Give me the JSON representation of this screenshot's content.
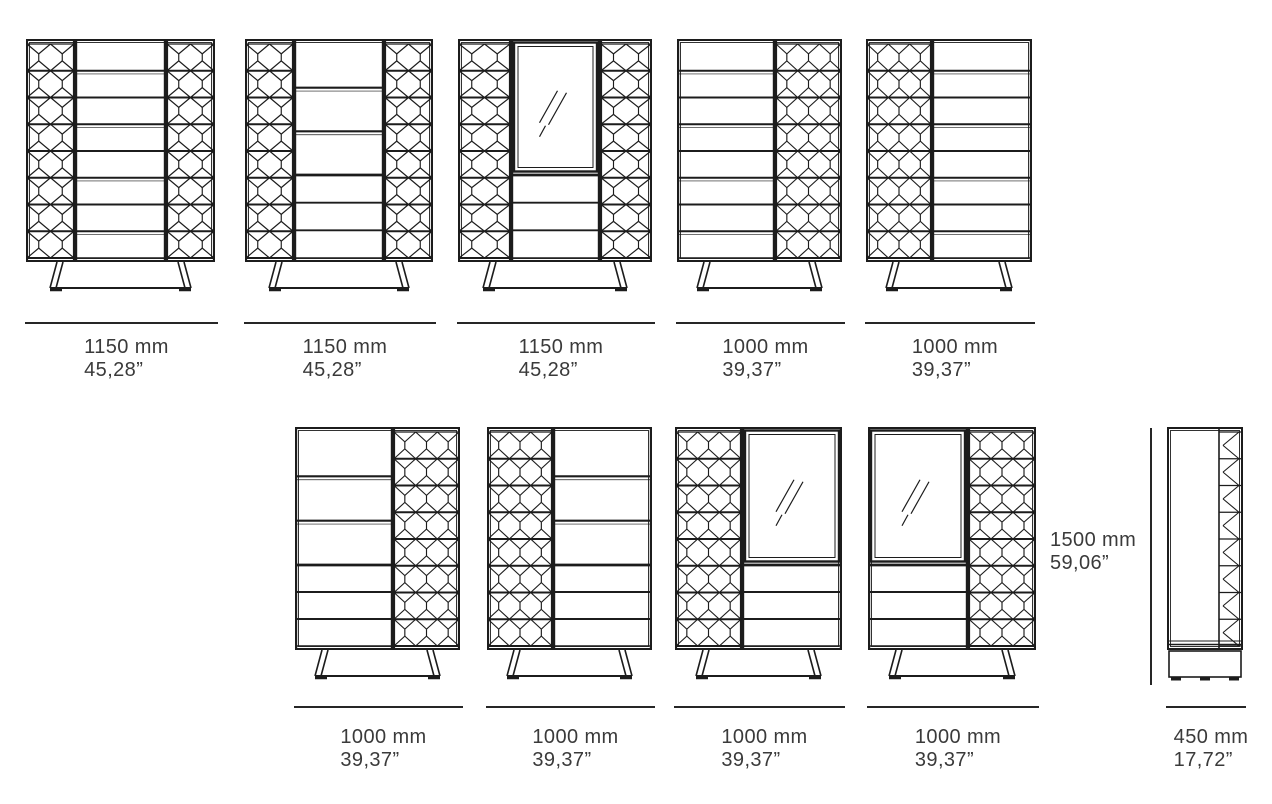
{
  "diagram": {
    "title": "Highboard dimension drawings",
    "colors": {
      "line": "#1c1c1c",
      "text": "#3a3a3a",
      "background": "#ffffff"
    },
    "height_annotation": {
      "mm": "1500 mm",
      "inches": "59,06”"
    },
    "height_line": {
      "x": 1150,
      "y1": 428,
      "y2": 685
    },
    "figures": [
      {
        "name": "highboard-1150-pattern-doors-8-drawers",
        "view": "front",
        "x": 26,
        "y": 39,
        "w": 189,
        "dim_y": 322,
        "label_y": 336,
        "label": {
          "mm": "1150 mm",
          "inches": "45,28”"
        },
        "sections": [
          {
            "type": "pattern",
            "w": 49,
            "cells": 2
          },
          {
            "type": "drawers8",
            "w": 91
          },
          {
            "type": "pattern",
            "w": 49,
            "cells": 2
          }
        ]
      },
      {
        "name": "highboard-1150-three-big-drawers",
        "view": "front",
        "x": 245,
        "y": 39,
        "w": 188,
        "dim_y": 322,
        "label_y": 336,
        "label": {
          "mm": "1150 mm",
          "inches": "45,28”"
        },
        "sections": [
          {
            "type": "pattern",
            "w": 49,
            "cells": 2
          },
          {
            "type": "drawersBig",
            "w": 90,
            "split": 136
          },
          {
            "type": "pattern",
            "w": 49,
            "cells": 2
          }
        ]
      },
      {
        "name": "highboard-1150-glass-door",
        "view": "front",
        "x": 458,
        "y": 39,
        "w": 194,
        "dim_y": 322,
        "label_y": 336,
        "label": {
          "mm": "1150 mm",
          "inches": "45,28”"
        },
        "sections": [
          {
            "type": "pattern",
            "w": 53,
            "cells": 2
          },
          {
            "type": "mirror",
            "w": 89,
            "split": 136
          },
          {
            "type": "pattern",
            "w": 52,
            "cells": 2
          }
        ]
      },
      {
        "name": "highboard-1000-drawers-left-pattern-right",
        "view": "front",
        "x": 677,
        "y": 39,
        "w": 165,
        "dim_y": 322,
        "label_y": 336,
        "label": {
          "mm": "1000 mm",
          "inches": "39,37”"
        },
        "sections": [
          {
            "type": "drawers8",
            "w": 98
          },
          {
            "type": "pattern",
            "w": 67,
            "cells": 3
          }
        ]
      },
      {
        "name": "highboard-1000-pattern-left-drawers-right",
        "view": "front",
        "x": 866,
        "y": 39,
        "w": 166,
        "dim_y": 322,
        "label_y": 336,
        "label": {
          "mm": "1000 mm",
          "inches": "39,37”"
        },
        "sections": [
          {
            "type": "pattern",
            "w": 66,
            "cells": 3
          },
          {
            "type": "drawers8",
            "w": 100
          }
        ]
      },
      {
        "name": "highboard-1000-big-drawers-left-pattern-right",
        "view": "front",
        "x": 295,
        "y": 427,
        "w": 165,
        "dim_y": 706,
        "label_y": 726,
        "label": {
          "mm": "1000 mm",
          "inches": "39,37”"
        },
        "sections": [
          {
            "type": "drawersBig",
            "w": 98,
            "split": 138
          },
          {
            "type": "pattern",
            "w": 67,
            "cells": 3
          }
        ]
      },
      {
        "name": "highboard-1000-pattern-left-big-drawers-right",
        "view": "front",
        "x": 487,
        "y": 427,
        "w": 165,
        "dim_y": 706,
        "label_y": 726,
        "label": {
          "mm": "1000 mm",
          "inches": "39,37”"
        },
        "sections": [
          {
            "type": "pattern",
            "w": 66,
            "cells": 3
          },
          {
            "type": "drawersBig",
            "w": 99,
            "split": 138
          }
        ]
      },
      {
        "name": "highboard-1000-pattern-left-glass-door-right",
        "view": "front",
        "x": 675,
        "y": 427,
        "w": 167,
        "dim_y": 706,
        "label_y": 726,
        "label": {
          "mm": "1000 mm",
          "inches": "39,37”"
        },
        "sections": [
          {
            "type": "pattern",
            "w": 67,
            "cells": 3
          },
          {
            "type": "mirror",
            "w": 100,
            "split": 138
          }
        ]
      },
      {
        "name": "highboard-1000-glass-door-left-pattern-right",
        "view": "front",
        "x": 868,
        "y": 427,
        "w": 168,
        "dim_y": 706,
        "label_y": 726,
        "label": {
          "mm": "1000 mm",
          "inches": "39,37”"
        },
        "sections": [
          {
            "type": "mirror",
            "w": 100,
            "split": 138
          },
          {
            "type": "pattern",
            "w": 68,
            "cells": 3
          }
        ]
      },
      {
        "name": "highboard-side-view",
        "view": "side",
        "x": 1167,
        "y": 427,
        "w": 76,
        "dim_y": 706,
        "label_y": 726,
        "label": {
          "mm": "450 mm",
          "inches": "17,72”"
        }
      }
    ]
  }
}
